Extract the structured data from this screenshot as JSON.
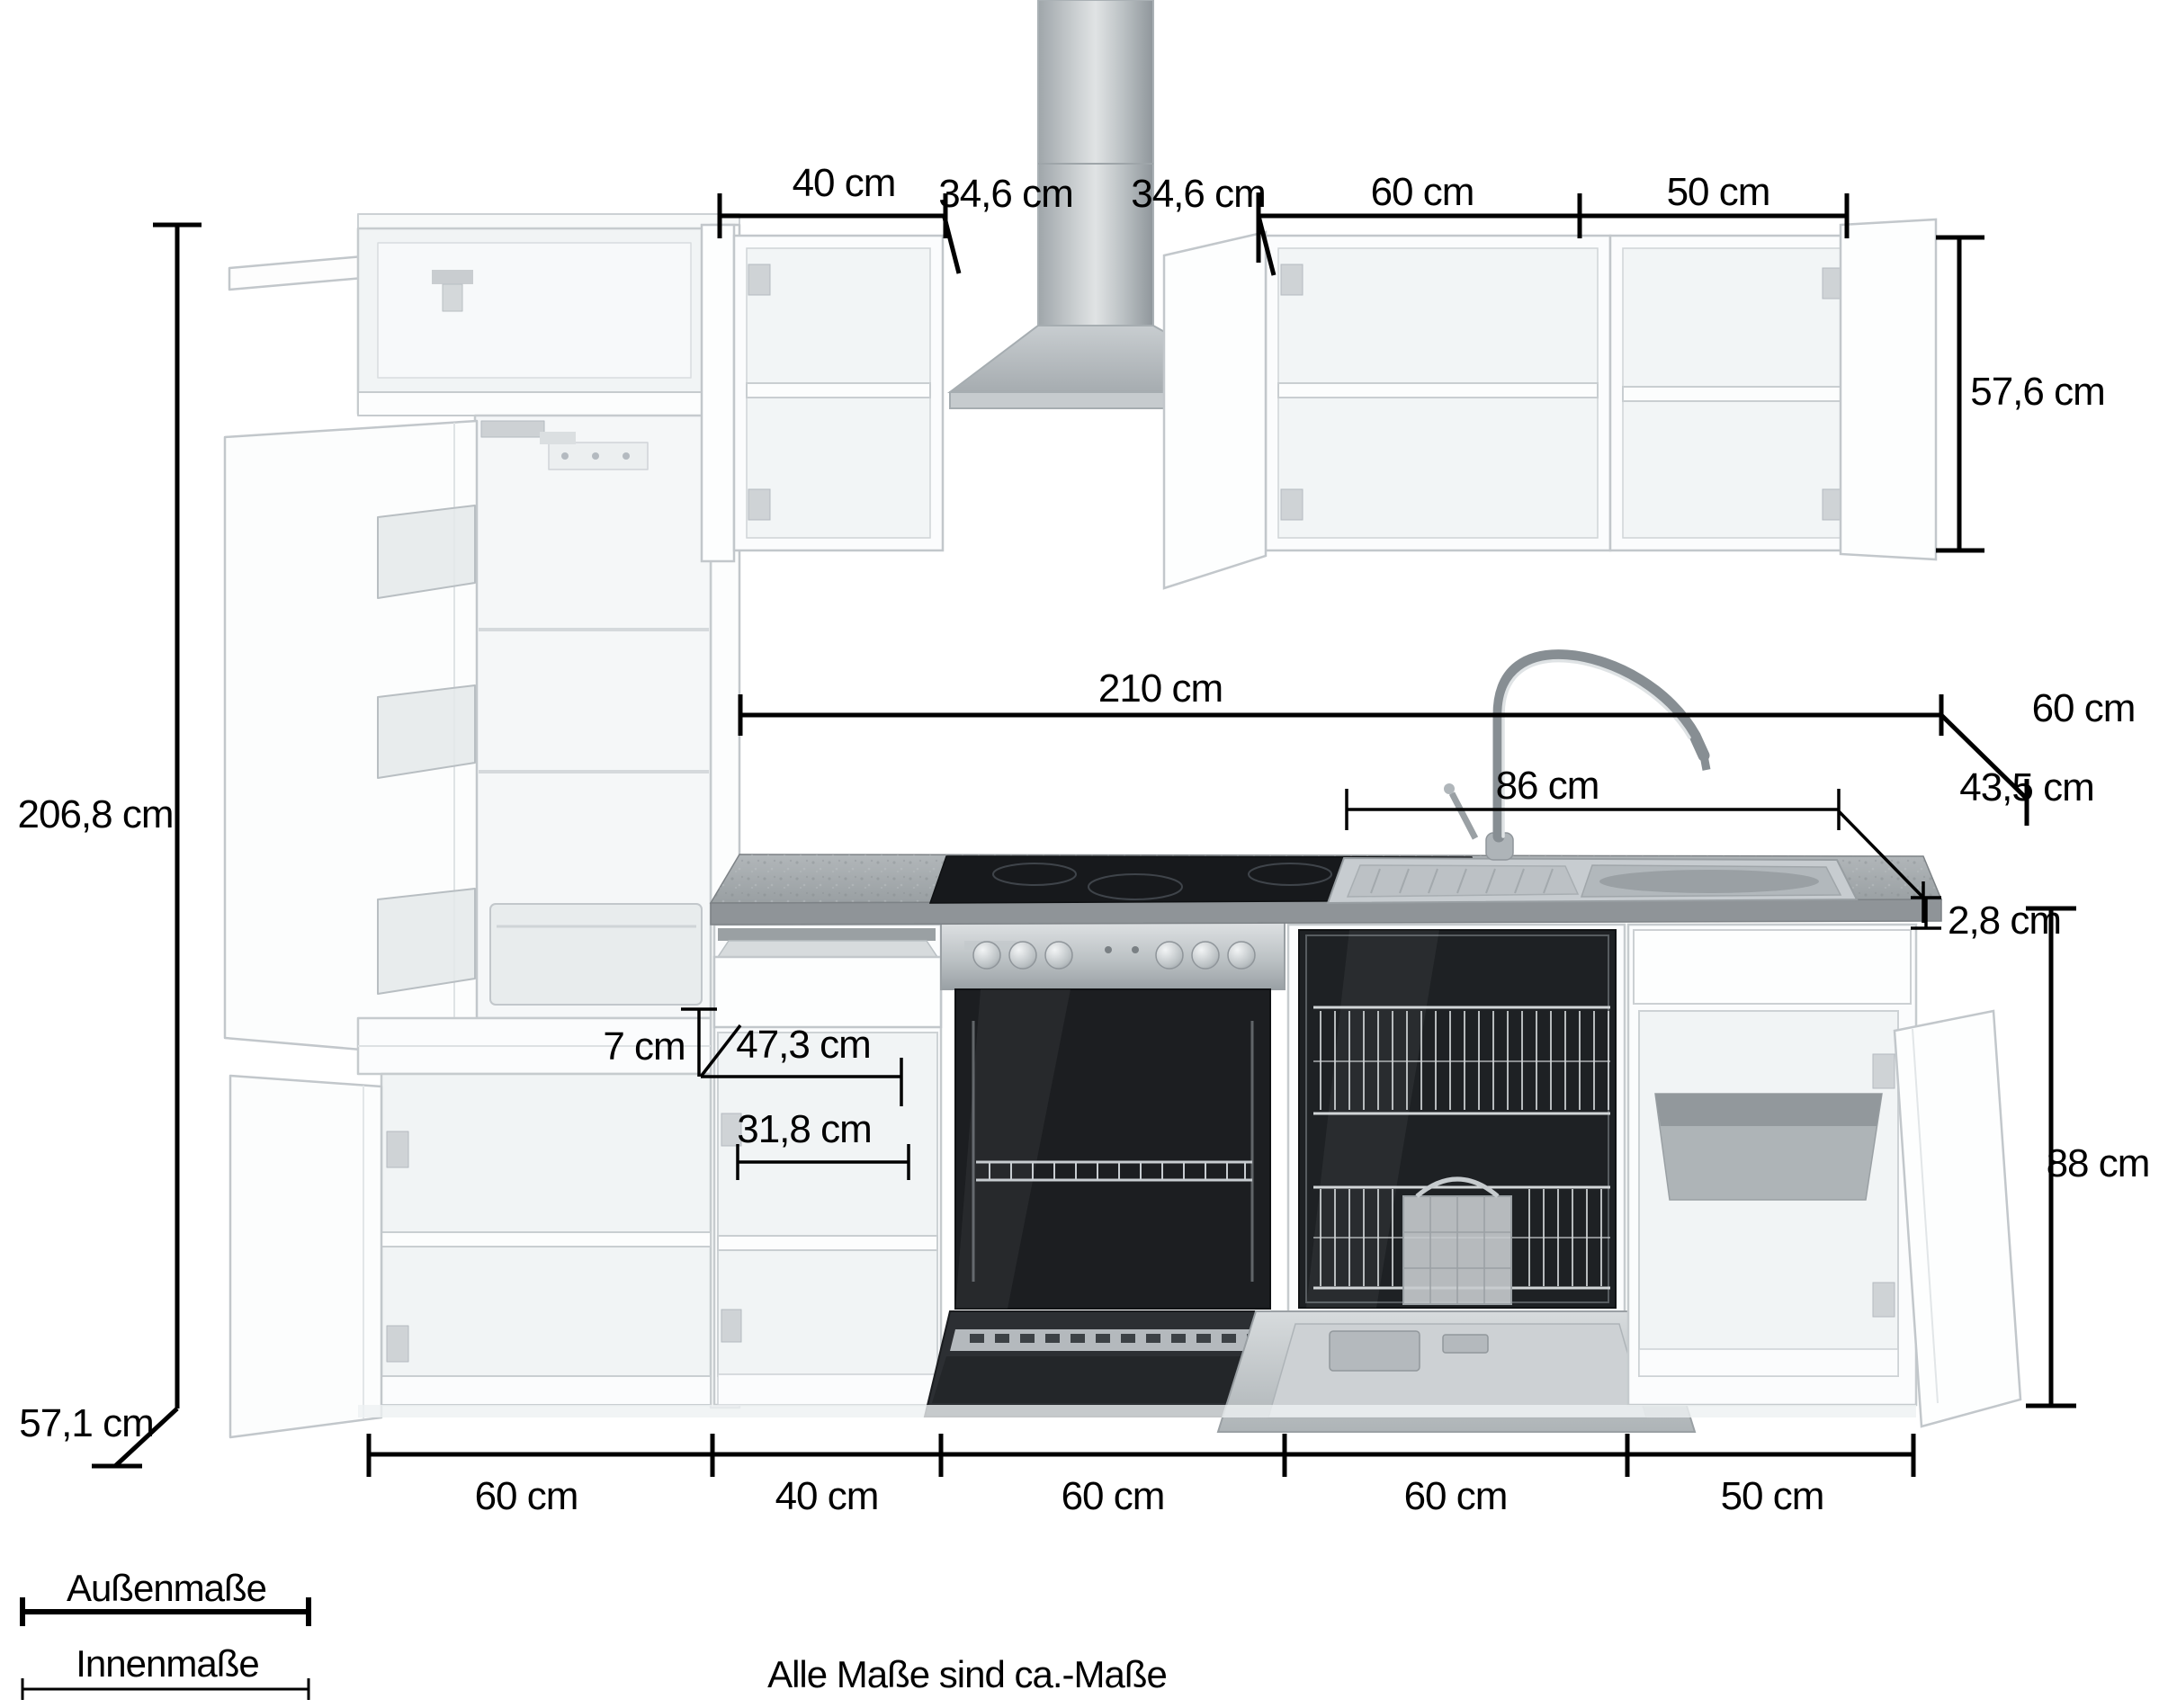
{
  "note": "Alle Maße sind ca.-Maße",
  "legend": {
    "outer": "Außenmaße",
    "inner": "Innenmaße"
  },
  "dims": {
    "wall40": "40 cm",
    "hood_depth_left": "34,6 cm",
    "hood_depth_right": "34,6 cm",
    "wall60": "60 cm",
    "wall50": "50 cm",
    "wall_height": "57,6 cm",
    "total_height": "206,8 cm",
    "worktop_length": "210 cm",
    "worktop_depth": "60 cm",
    "sink_length": "86 cm",
    "sink_depth": "43,5 cm",
    "worktop_thickness": "2,8 cm",
    "drawer_height": "7 cm",
    "drawer_depth": "47,3 cm",
    "inner_width": "31,8 cm",
    "base_height": "88 cm",
    "base_depth": "57,1 cm",
    "base": [
      "60 cm",
      "40 cm",
      "60 cm",
      "60 cm",
      "50 cm"
    ]
  }
}
